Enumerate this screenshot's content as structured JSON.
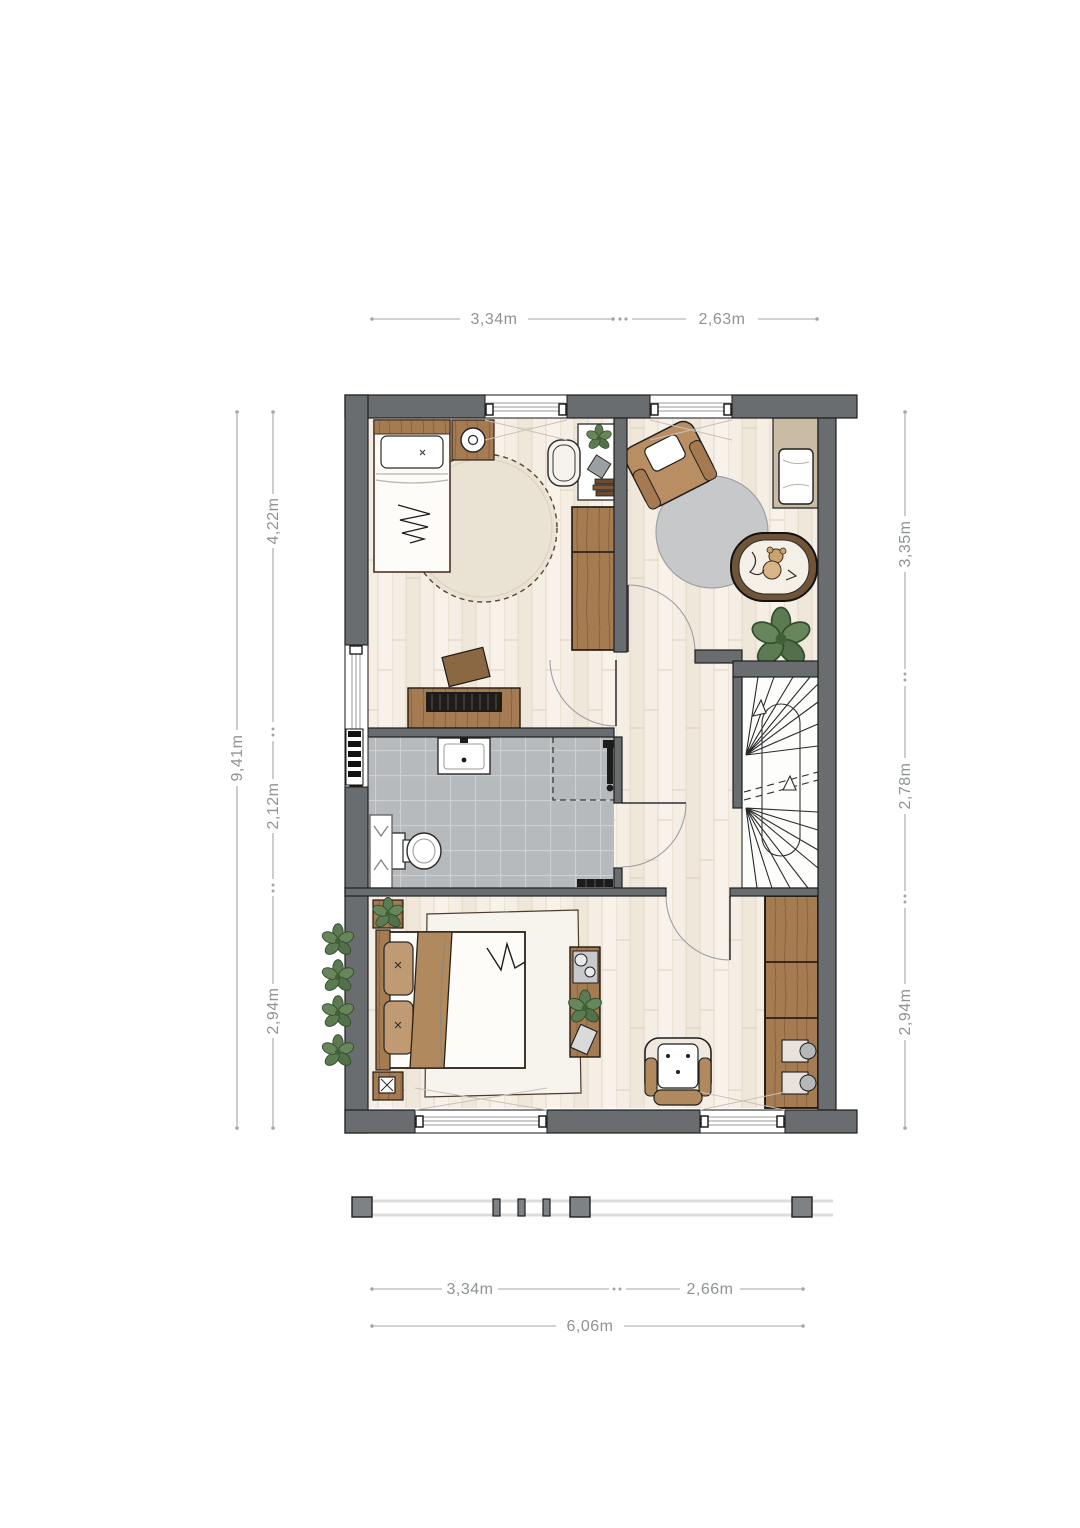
{
  "drawing": {
    "type": "floorplan",
    "floor_text_labels": "none"
  },
  "dimensions": {
    "top": {
      "left_span": "3,34m",
      "right_span": "2,63m"
    },
    "left": {
      "total": "9,41m",
      "segments": [
        "4,22m",
        "2,12m",
        "2,94m"
      ]
    },
    "right": {
      "segments": [
        "3,35m",
        "2,78m",
        "2,94m"
      ]
    },
    "bottom": {
      "left_span": "3,34m",
      "right_span": "2,66m",
      "total": "6,06m"
    }
  },
  "palette": {
    "wall": "#696d6f",
    "wall_outline": "#1f1f1f",
    "wood_floor": "#f4eee5",
    "plank_line": "#e3d8c6",
    "tile": "#b7babc",
    "tile_grout": "#cdd0d2",
    "furniture_wood": "#a57b52",
    "furniture_wood_dark": "#8a6240",
    "rug_beige": "#eae3d3",
    "rug_gray": "#c6c8ca",
    "rug_white": "#f7f4ee",
    "chair_brown": "#b98e62",
    "plant_green": "#5c7b53",
    "dimension_line": "#a0a5a8",
    "dimension_text": "#8e9396",
    "white_fixture": "#ffffff"
  },
  "icons": {
    "plant": "leaf-cluster",
    "stairs": "winder-stair-fan",
    "door": "quarter-arc-swing",
    "window": "triple-line-glazing",
    "radiator": "rung-ladder",
    "shower": "dashed-square"
  }
}
